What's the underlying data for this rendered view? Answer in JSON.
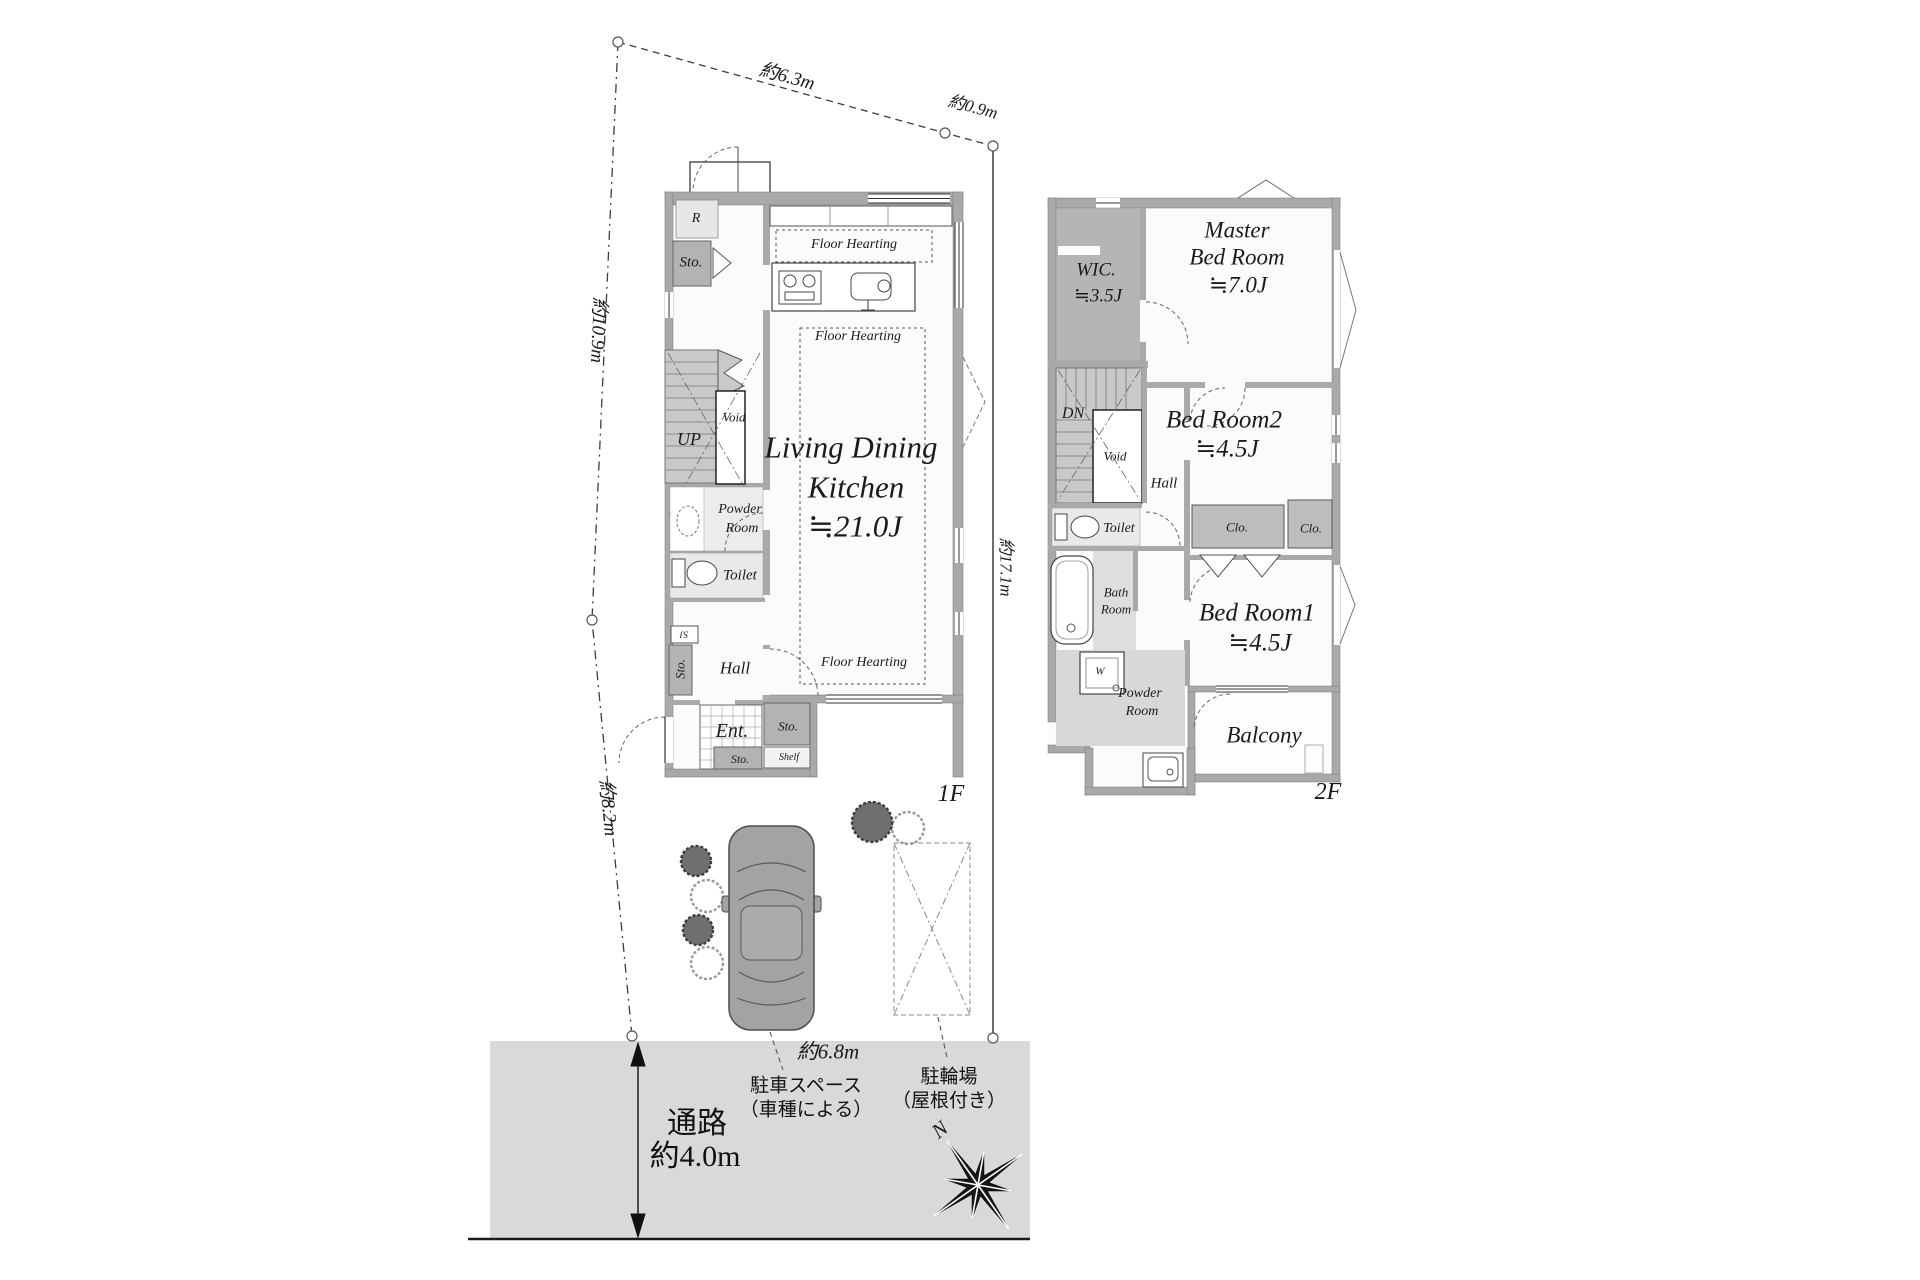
{
  "dimensions": {
    "top": "約6.3m",
    "top_right": "約0.9m",
    "left_upper": "約10.9m",
    "left_lower": "約8.2m",
    "right_side": "約17.1m",
    "parking_width": "約6.8m"
  },
  "site": {
    "road_name": "通路",
    "road_width": "約4.0m",
    "parking_line1": "駐車スペース",
    "parking_line2": "（車種による）",
    "bicycle_line1": "駐輪場",
    "bicycle_line2": "（屋根付き）",
    "north": "N"
  },
  "floor1": {
    "tag": "1F",
    "ldk_line1": "Living Dining",
    "ldk_line2": "Kitchen",
    "ldk_size": "≒21.0J",
    "floor_heating": "Floor Hearting",
    "up": "UP",
    "void": "Void",
    "refrigerator": "R",
    "storage": "Sto.",
    "powder_line1": "Powder",
    "powder_line2": "Room",
    "toilet": "Toilet",
    "hall": "Hall",
    "entrance": "Ent.",
    "shelf": "Shelf",
    "shoes": "SJ"
  },
  "floor2": {
    "tag": "2F",
    "wic_line1": "WIC.",
    "wic_size": "≒3.5J",
    "master_line1": "Master",
    "master_line2": "Bed Room",
    "master_size": "≒7.0J",
    "bedroom2_name": "Bed Room2",
    "bedroom2_size": "≒4.5J",
    "bedroom1_name": "Bed Room1",
    "bedroom1_size": "≒4.5J",
    "closet": "Clo.",
    "dn": "DN",
    "void": "Void",
    "hall": "Hall",
    "toilet": "Toilet",
    "bath_line1": "Bath",
    "bath_line2": "Room",
    "washer": "W",
    "powder_line1": "Powder",
    "powder_line2": "Room",
    "balcony": "Balcony"
  }
}
